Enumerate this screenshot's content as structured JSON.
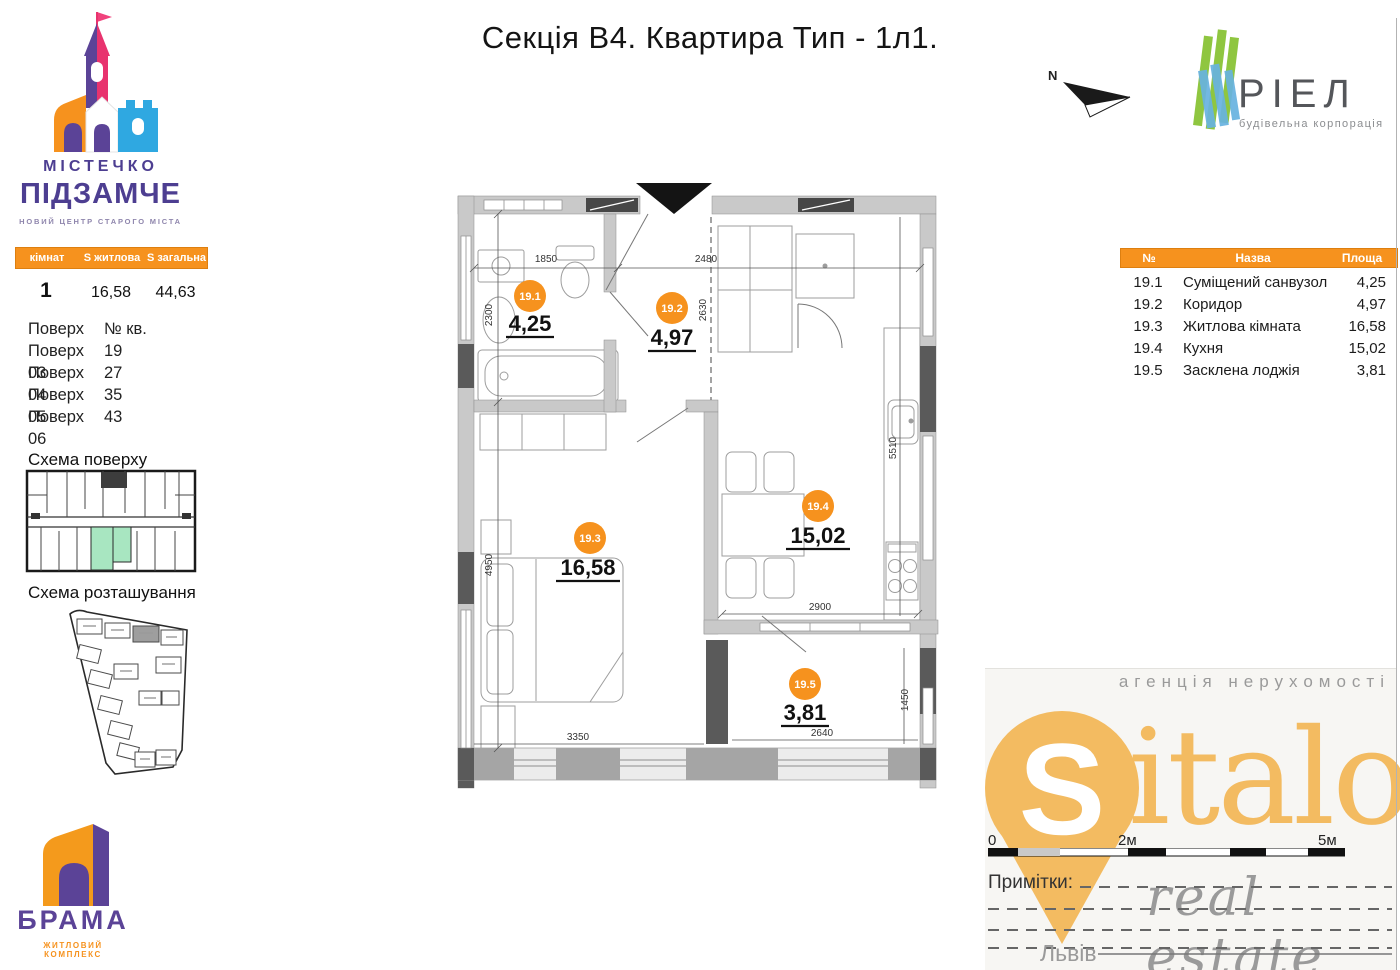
{
  "title": "Секція В4. Квартира Тип - 1л1.",
  "north_label": "N",
  "pidzamche": {
    "line1": "МІСТЕЧКО",
    "line2": "ПІДЗАМЧЕ",
    "tagline": "НОВИЙ ЦЕНТР СТАРОГО МІСТА"
  },
  "brama": {
    "name": "БРАМА",
    "tagline": "ЖИТЛОВИЙ КОМПЛЕКС"
  },
  "riel": {
    "name": "РІЕЛ",
    "tagline": "будівельна корпорація"
  },
  "summary_table": {
    "headers": [
      "кімнат",
      "S житлова",
      "S загальна"
    ],
    "rooms": "1",
    "s_living": "16,58",
    "s_total": "44,63"
  },
  "floors_table": {
    "col1": "Поверх",
    "col2": "№ кв.",
    "rows": [
      {
        "floor": "Поверх 03",
        "apt": "19"
      },
      {
        "floor": "Поверх 04",
        "apt": "27"
      },
      {
        "floor": "Поверх 05",
        "apt": "35"
      },
      {
        "floor": "Поверх 06",
        "apt": "43"
      }
    ]
  },
  "schemes": {
    "floor_label": "Схема поверху",
    "location_label": "Схема розташування"
  },
  "plan": {
    "rooms": [
      {
        "id": "19.1",
        "area": "4,25"
      },
      {
        "id": "19.2",
        "area": "4,97"
      },
      {
        "id": "19.3",
        "area": "16,58"
      },
      {
        "id": "19.4",
        "area": "15,02"
      },
      {
        "id": "19.5",
        "area": "3,81"
      }
    ],
    "dimensions": [
      "1850",
      "2480",
      "2300",
      "2630",
      "4950",
      "5510",
      "2900",
      "3350",
      "2640",
      "1450"
    ]
  },
  "rooms_table": {
    "headers": [
      "№",
      "Назва",
      "Площа"
    ],
    "rows": [
      {
        "num": "19.1",
        "name": "Суміщений санвузол",
        "area": "4,25"
      },
      {
        "num": "19.2",
        "name": "Коридор",
        "area": "4,97"
      },
      {
        "num": "19.3",
        "name": "Житлова кімната",
        "area": "16,58"
      },
      {
        "num": "19.4",
        "name": "Кухня",
        "area": "15,02"
      },
      {
        "num": "19.5",
        "name": "Засклена лоджія",
        "area": "3,81"
      }
    ]
  },
  "scale_bar": {
    "t0": "0",
    "t2": "2м",
    "t5": "5м"
  },
  "sitalo": {
    "agency_line": "агенція нерухомості",
    "logo_s": "S",
    "logo_rest": "italo",
    "sub_line": "real estate",
    "notes_label": "Примітки:",
    "city": "Львів"
  },
  "colors": {
    "accent_orange": "#F6921E",
    "sitalo_gold": "#F3BB61",
    "highlight_green": "#A8E6C1",
    "riel_green": "#8FC640",
    "riel_blue": "#68B3E0",
    "brand_purple": "#5B4397",
    "brand_magenta": "#E8336E",
    "brand_blue": "#2FA8E1"
  }
}
